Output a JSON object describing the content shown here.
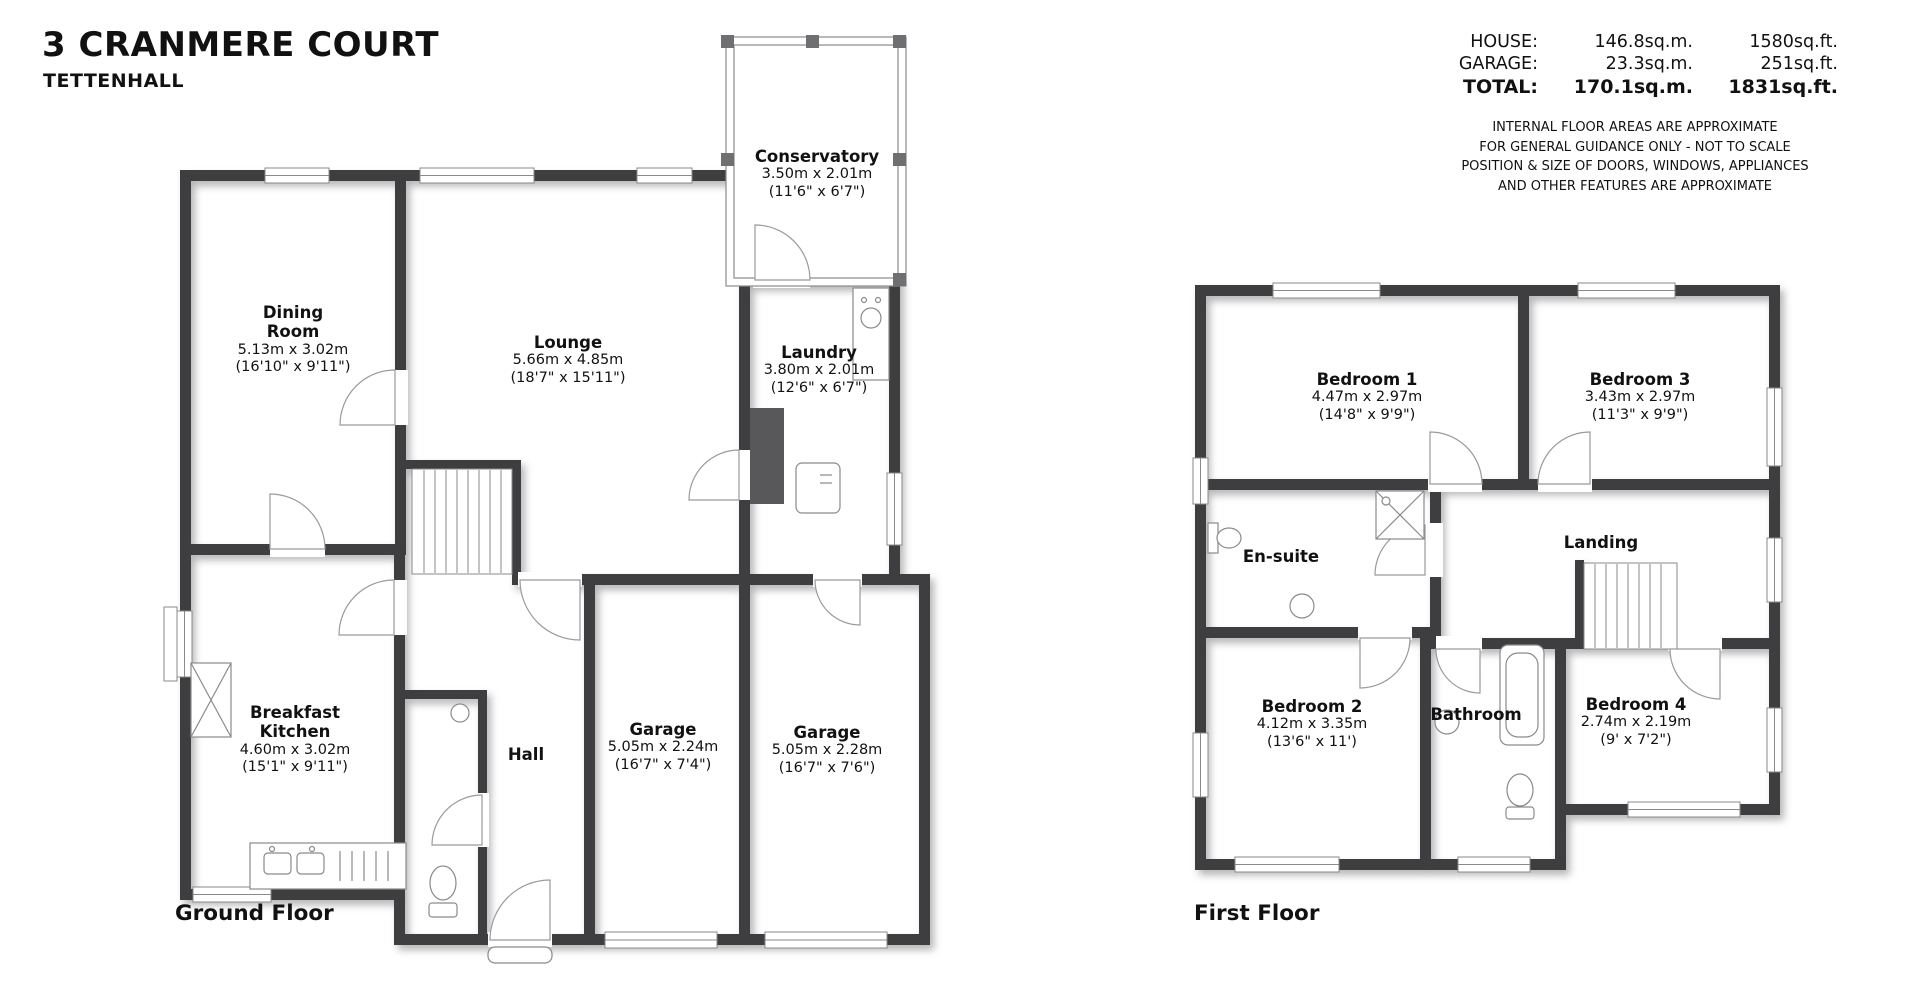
{
  "header": {
    "title": "3 CRANMERE COURT",
    "subtitle": "TETTENHALL"
  },
  "area_summary": {
    "rows": {
      "house": {
        "label": "HOUSE:",
        "sqm": "146.8sq.m.",
        "sqft": "1580sq.ft."
      },
      "garage": {
        "label": "GARAGE:",
        "sqm": "23.3sq.m.",
        "sqft": "251sq.ft."
      },
      "total": {
        "label": "TOTAL:",
        "sqm": "170.1sq.m.",
        "sqft": "1831sq.ft."
      }
    },
    "disclaimer": {
      "line1": "INTERNAL FLOOR AREAS ARE APPROXIMATE",
      "line2": "FOR GENERAL GUIDANCE ONLY - NOT TO SCALE",
      "line3": "POSITION & SIZE OF DOORS, WINDOWS, APPLIANCES",
      "line4": "AND OTHER FEATURES ARE APPROXIMATE"
    }
  },
  "ground_floor": {
    "caption": "Ground Floor",
    "rooms": {
      "dining": {
        "name": "Dining\nRoom",
        "metric": "5.13m x 3.02m",
        "imperial": "(16'10\" x 9'11\")"
      },
      "lounge": {
        "name": "Lounge",
        "metric": "5.66m x 4.85m",
        "imperial": "(18'7\" x 15'11\")"
      },
      "conservatory": {
        "name": "Conservatory",
        "metric": "3.50m x 2.01m",
        "imperial": "(11'6\" x 6'7\")"
      },
      "laundry": {
        "name": "Laundry",
        "metric": "3.80m x 2.01m",
        "imperial": "(12'6\" x 6'7\")"
      },
      "kitchen": {
        "name": "Breakfast\nKitchen",
        "metric": "4.60m x 3.02m",
        "imperial": "(15'1\" x 9'11\")"
      },
      "hall": {
        "name": "Hall"
      },
      "garage1": {
        "name": "Garage",
        "metric": "5.05m x 2.24m",
        "imperial": "(16'7\" x 7'4\")"
      },
      "garage2": {
        "name": "Garage",
        "metric": "5.05m x 2.28m",
        "imperial": "(16'7\" x 7'6\")"
      }
    }
  },
  "first_floor": {
    "caption": "First Floor",
    "rooms": {
      "bedroom1": {
        "name": "Bedroom 1",
        "metric": "4.47m x 2.97m",
        "imperial": "(14'8\" x 9'9\")"
      },
      "bedroom3": {
        "name": "Bedroom 3",
        "metric": "3.43m x 2.97m",
        "imperial": "(11'3\" x 9'9\")"
      },
      "ensuite": {
        "name": "En-suite"
      },
      "landing": {
        "name": "Landing"
      },
      "bedroom2": {
        "name": "Bedroom 2",
        "metric": "4.12m x 3.35m",
        "imperial": "(13'6\" x 11')"
      },
      "bathroom": {
        "name": "Bathroom"
      },
      "bedroom4": {
        "name": "Bedroom 4",
        "metric": "2.74m x 2.19m",
        "imperial": "(9' x 7'2\")"
      }
    }
  }
}
